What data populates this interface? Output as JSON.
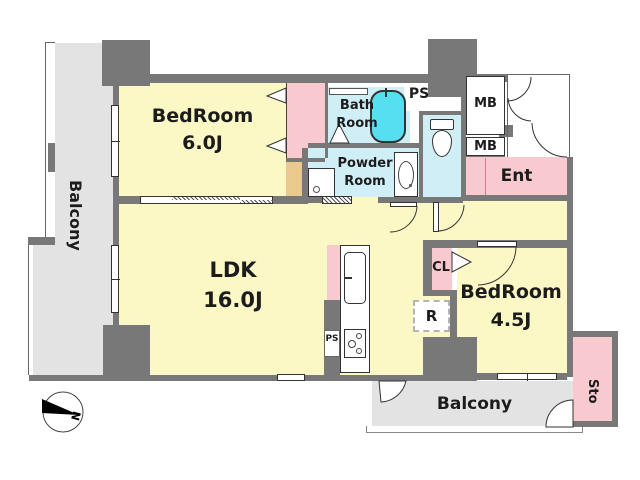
{
  "floorplan": {
    "balcony_left": "Balcony",
    "balcony_bottom": "Balcony",
    "bedroom1": {
      "name": "BedRoom",
      "size": "6.0J"
    },
    "bedroom2": {
      "name": "BedRoom",
      "size": "4.5J"
    },
    "ldk": {
      "name": "LDK",
      "size": "16.0J"
    },
    "bath": {
      "line1": "Bath",
      "line2": "Room"
    },
    "powder": {
      "line1": "Powder",
      "line2": "Room"
    },
    "entrance": "Ent",
    "storage": "Sto",
    "closet": "CL",
    "refrigerator": "R",
    "pipe_space_top": "PS",
    "pipe_space_kitchen": "PS",
    "meter_box_top": "MB",
    "meter_box_bottom": "MB",
    "compass_north": "N"
  },
  "colors": {
    "wall": "#787878",
    "room_yellow": "#fbf8c5",
    "wet_area_blue": "#cfeef6",
    "bathtub_cyan": "#55dff1",
    "accent_pink": "#f8cacf",
    "closet_tan": "#eac98f",
    "balcony_gray": "#e3e3e3"
  }
}
